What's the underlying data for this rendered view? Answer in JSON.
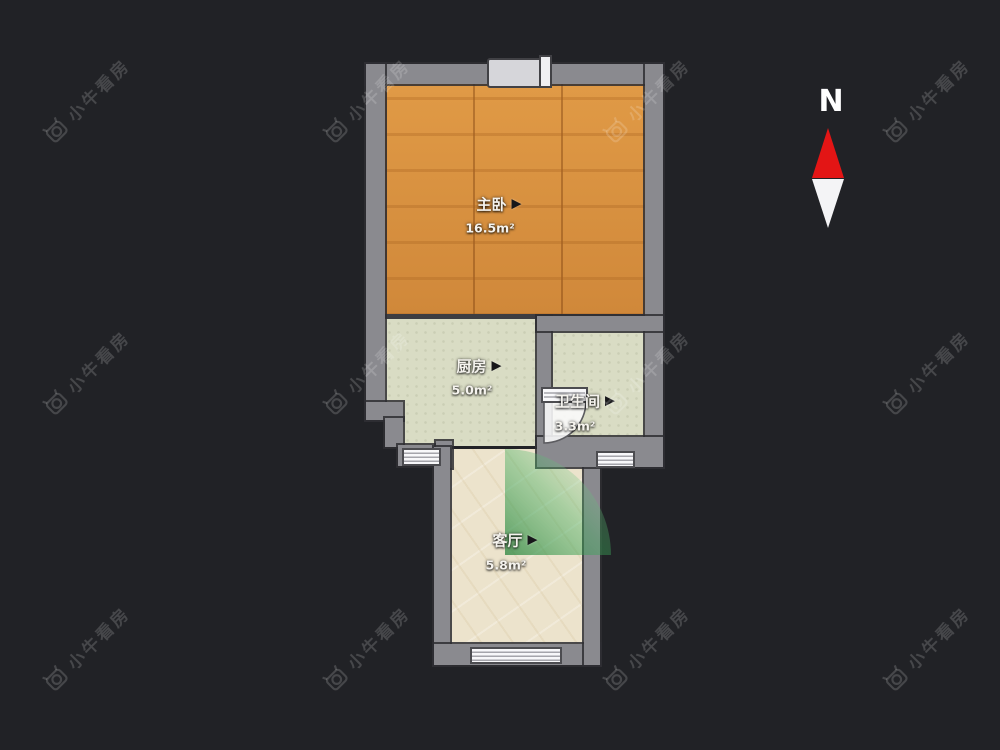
{
  "watermark": {
    "text": "小牛看房",
    "icon": "bull-camera-logo-icon"
  },
  "compass": {
    "label": "N"
  },
  "ui": {
    "arrow": "▶"
  },
  "rooms": [
    {
      "id": "master-bedroom",
      "name": "主卧",
      "area": "16.5m²",
      "floor": "wood"
    },
    {
      "id": "kitchen",
      "name": "厨房",
      "area": "5.0m²",
      "floor": "green-tile"
    },
    {
      "id": "bathroom",
      "name": "卫生间",
      "area": "3.3m²",
      "floor": "green-tile"
    },
    {
      "id": "living-room",
      "name": "客厅",
      "area": "5.8m²",
      "floor": "beige-marble"
    }
  ],
  "colors": {
    "background": "#212226",
    "wall": "#8a8a8f",
    "wood_floor": "#d8913c",
    "tile_floor": "#d9dcc4",
    "marble_floor": "#ece3cc",
    "door_swing_green": "#1e8a3c",
    "compass_red": "#e31515"
  }
}
